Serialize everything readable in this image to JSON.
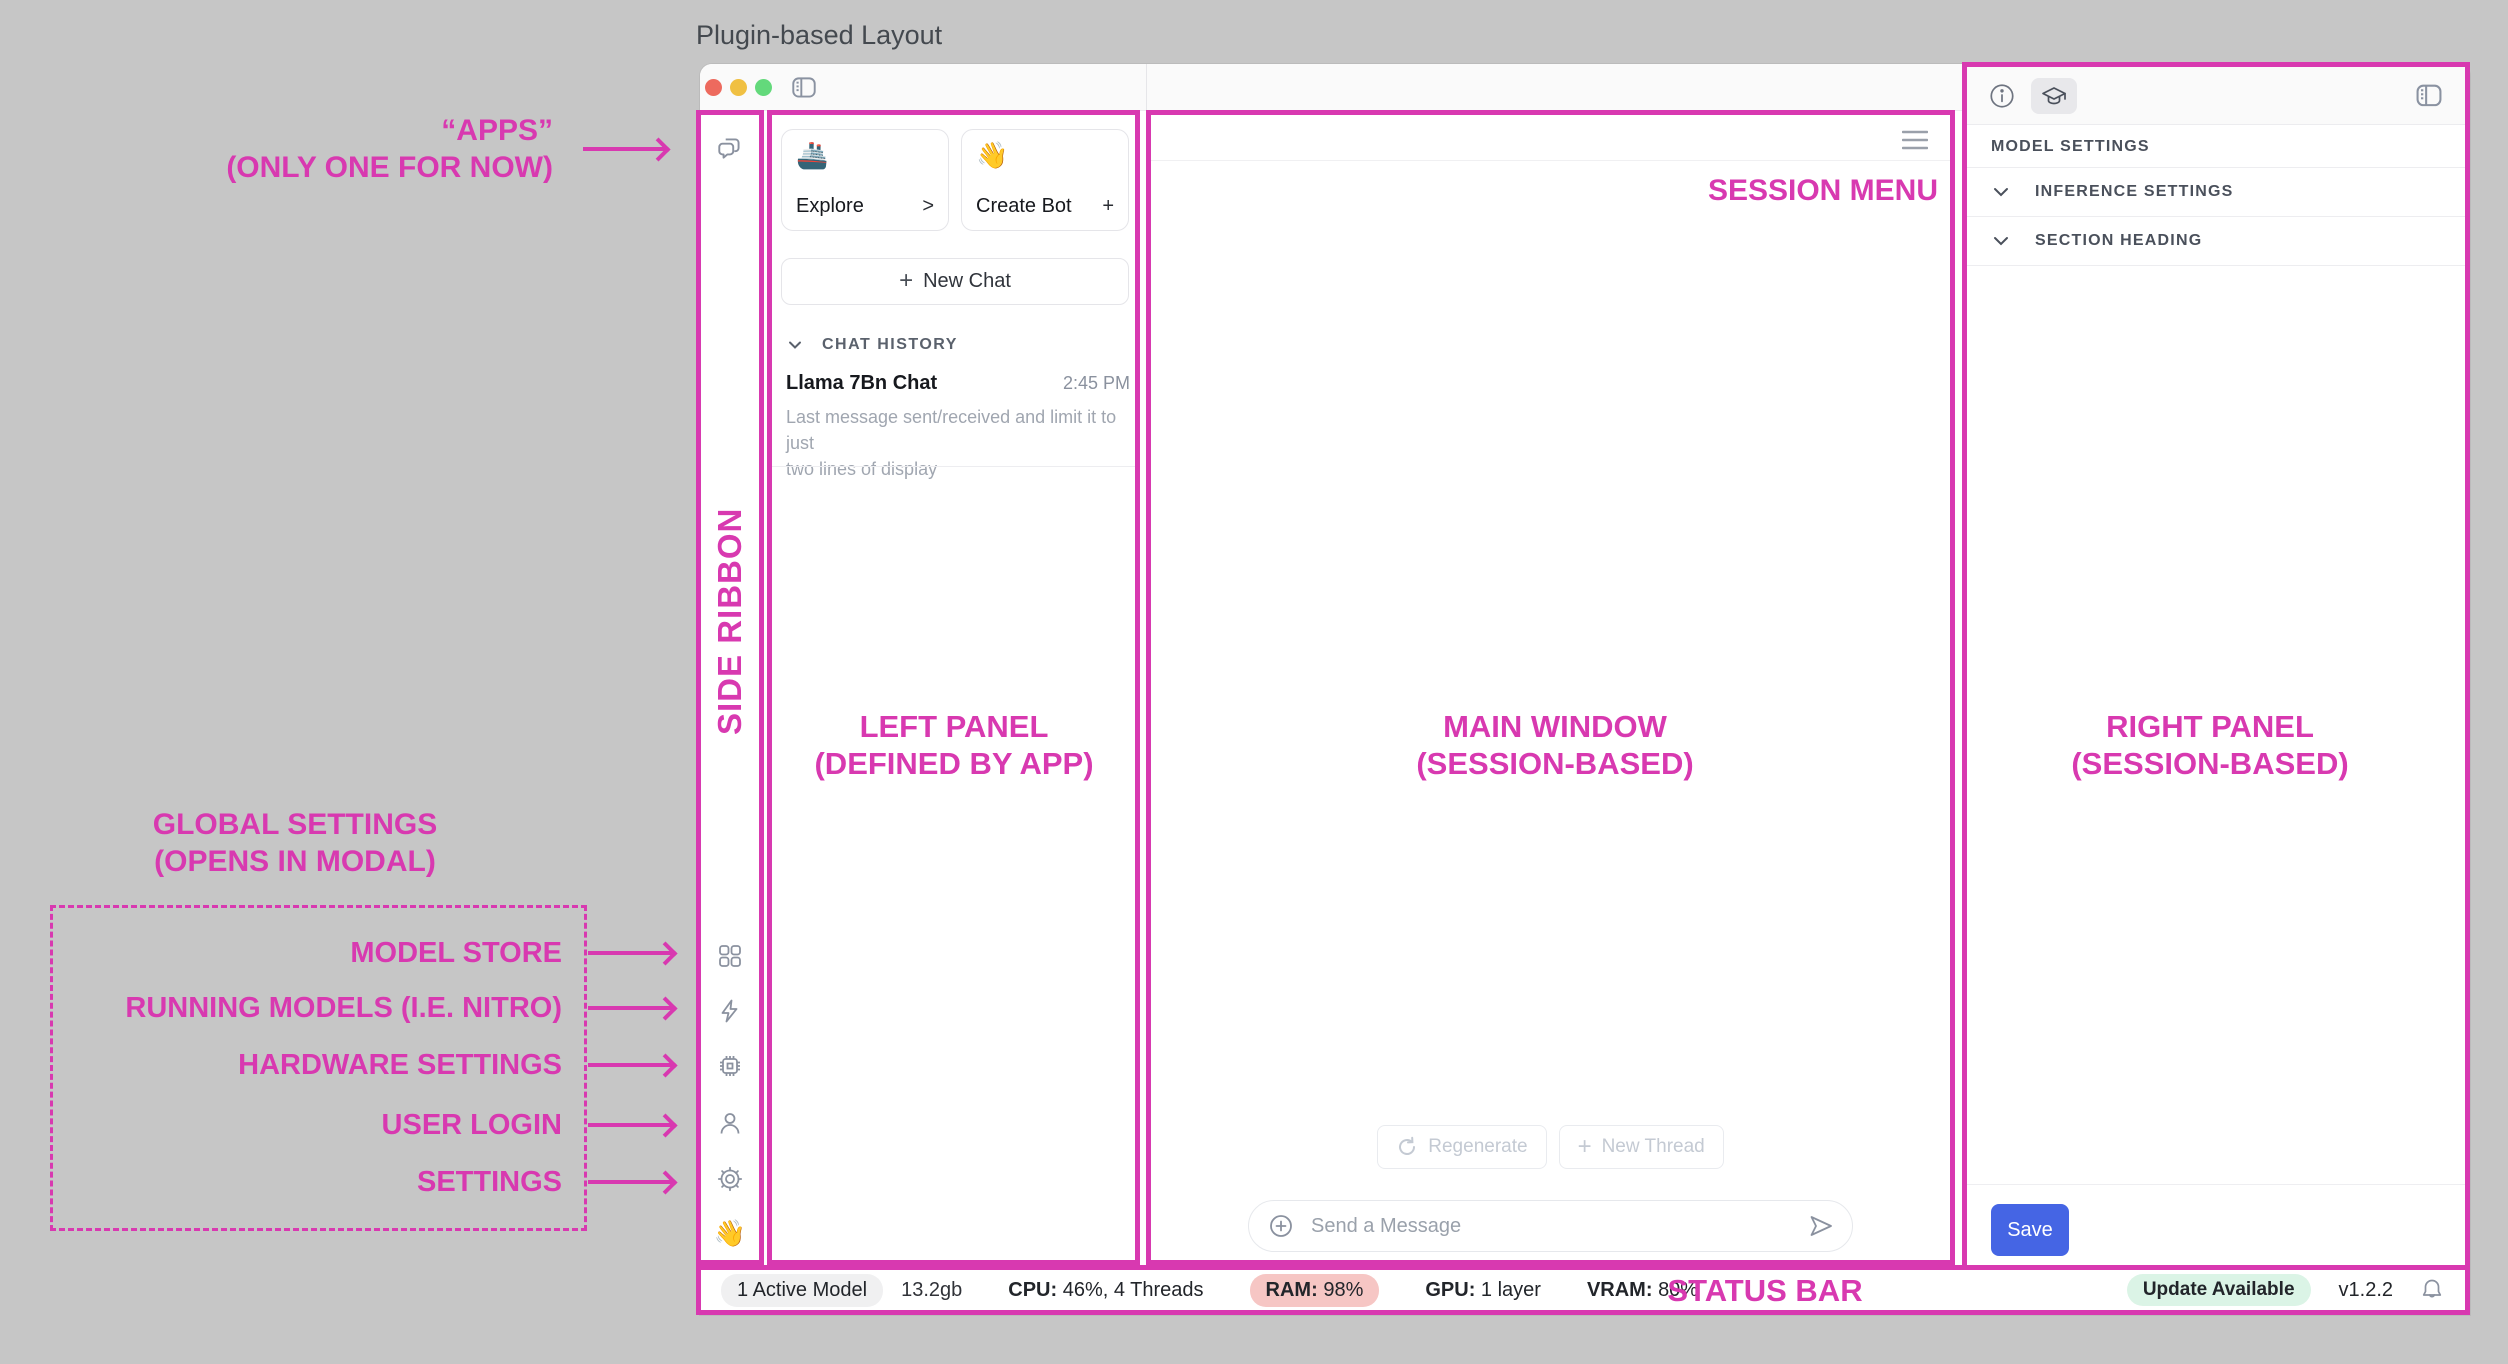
{
  "colors": {
    "annotation_pink": "#D839B0",
    "save_blue": "#4565E4",
    "ram_pill_bg": "#F6C6C4",
    "update_pill_bg": "#DBF4E6",
    "desktop_gray": "#C6C6C6"
  },
  "page_title": "Plugin-based Layout",
  "annotations": {
    "apps_line1": "“APPS”",
    "apps_line2": "(ONLY ONE FOR NOW)",
    "side_ribbon": "SIDE RIBBON",
    "left_panel_line1": "LEFT PANEL",
    "left_panel_line2": "(DEFINED BY APP)",
    "main_line1": "MAIN WINDOW",
    "main_line2": "(SESSION-BASED)",
    "right_line1": "RIGHT PANEL",
    "right_line2": "(SESSION-BASED)",
    "session_menu": "SESSION MENU",
    "global_line1": "GLOBAL SETTINGS",
    "global_line2": "(OPENS IN MODAL)",
    "status_bar": "STATUS BAR",
    "modal_items": [
      {
        "label": "MODEL STORE"
      },
      {
        "label": "RUNNING MODELS (I.E. NITRO)"
      },
      {
        "label": "HARDWARE SETTINGS"
      },
      {
        "label": "USER LOGIN"
      },
      {
        "label": "SETTINGS"
      }
    ]
  },
  "icons": {
    "ribbon_top": "chat-bubbles",
    "ribbon_bottom": [
      "apps-grid",
      "lightning-bolt",
      "cpu-chip",
      "user",
      "gear",
      "wave-emoji"
    ],
    "ribbon_bottom_emoji": "👋",
    "titlebar": "sidebar-toggle",
    "right_toolbar": [
      "info-circle",
      "graduation-cap",
      "panel-toggle"
    ],
    "main_toolbar": "hamburger-menu",
    "status": "bell"
  },
  "left_panel": {
    "explore_emoji": "🚢",
    "explore_label": "Explore",
    "explore_symbol": ">",
    "create_emoji": "👋",
    "create_label": "Create Bot",
    "create_symbol": "+",
    "new_chat_plus": "+",
    "new_chat_label": "New Chat",
    "history_header": "CHAT HISTORY",
    "chat": {
      "title": "Llama 7Bn Chat",
      "time": "2:45 PM",
      "desc_line1": "Last message sent/received and limit it to just",
      "desc_line2": "two lines of display"
    }
  },
  "main": {
    "regenerate_label": "Regenerate",
    "new_thread_plus": "+",
    "new_thread_label": "New Thread",
    "send_placeholder": "Send a Message"
  },
  "right_panel": {
    "header": "MODEL SETTINGS",
    "sections": [
      {
        "label": "INFERENCE SETTINGS"
      },
      {
        "label": "SECTION HEADING"
      }
    ],
    "save_label": "Save"
  },
  "status_bar": {
    "active_model": "1 Active Model",
    "size": "13.2gb",
    "cpu_label": "CPU:",
    "cpu_value": "46%, 4 Threads",
    "ram_label": "RAM:",
    "ram_value": "98%",
    "gpu_label": "GPU:",
    "gpu_value": "1 layer",
    "vram_label": "VRAM:",
    "vram_value": "80%",
    "update_badge": "Update Available",
    "version": "v1.2.2"
  }
}
